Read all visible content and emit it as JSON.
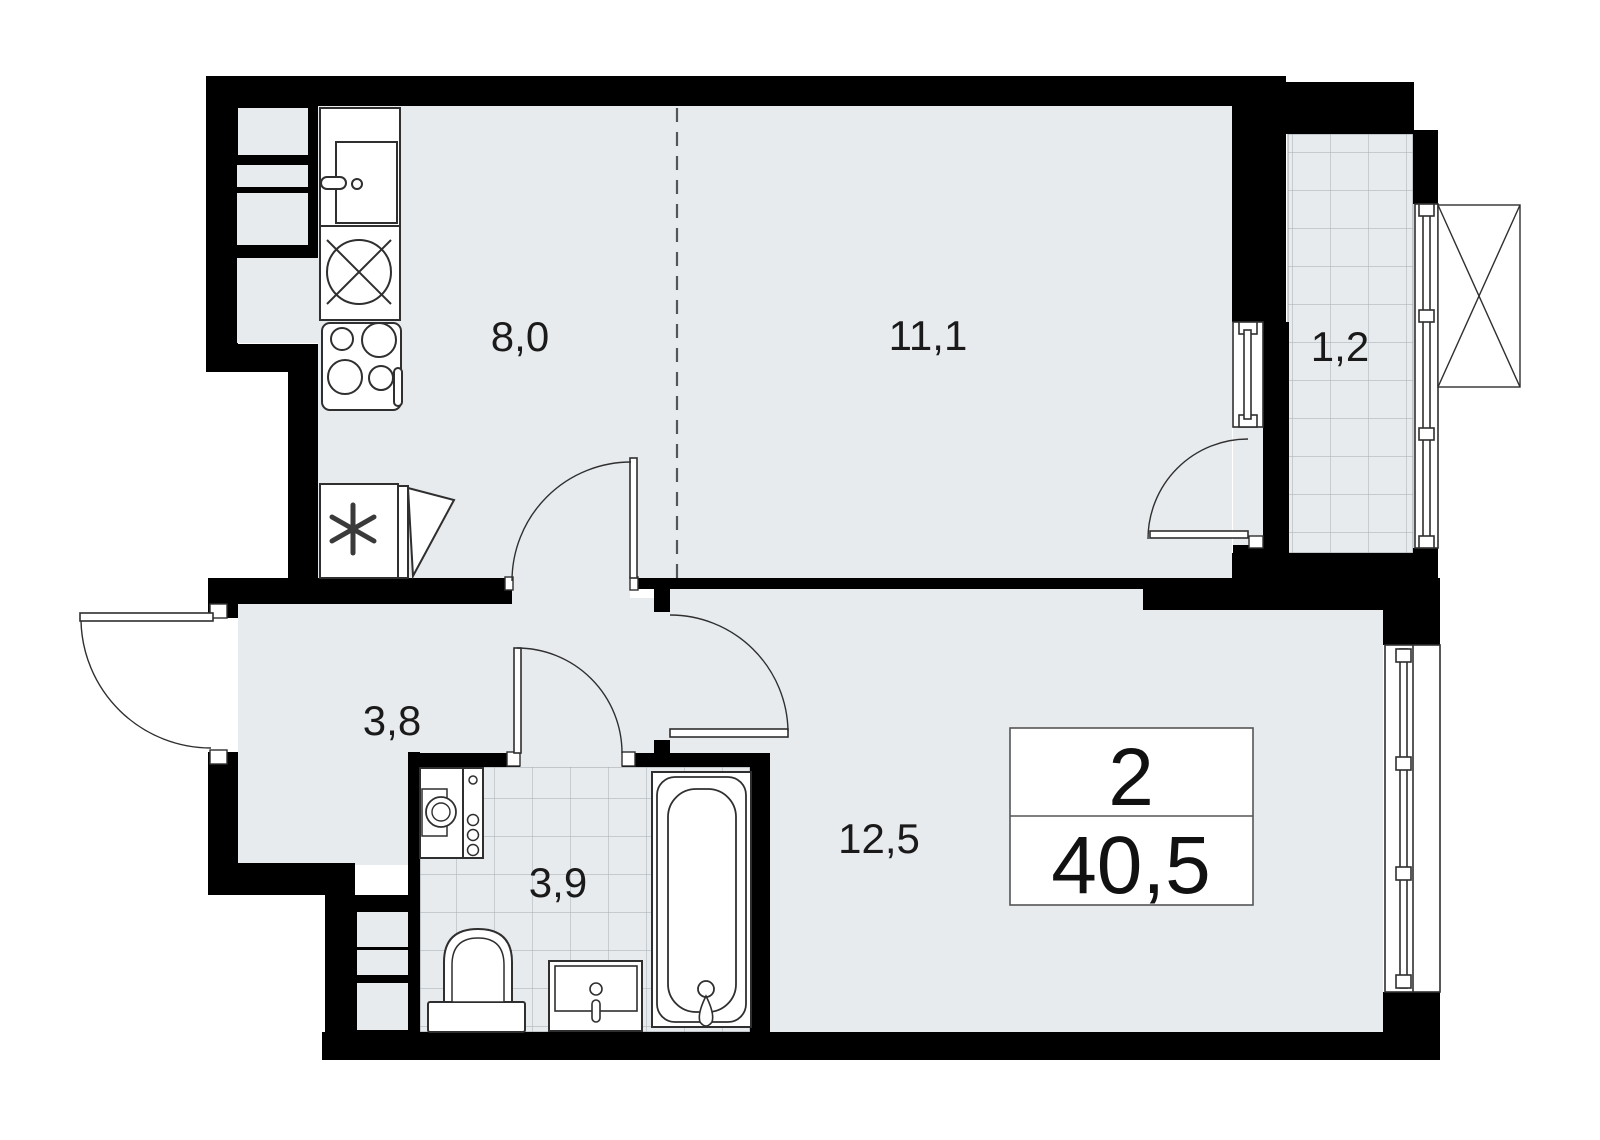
{
  "plan": {
    "type": "apartment-floor-plan",
    "rooms": [
      {
        "name": "kitchen",
        "area_label": "8,0"
      },
      {
        "name": "living-room",
        "area_label": "11,1"
      },
      {
        "name": "balcony",
        "area_label": "1,2"
      },
      {
        "name": "hallway",
        "area_label": "3,8"
      },
      {
        "name": "bathroom",
        "area_label": "3,9"
      },
      {
        "name": "bedroom-living",
        "area_label": "12,5"
      }
    ],
    "stamp": {
      "rooms_count": "2",
      "total_area": "40,5"
    },
    "colors": {
      "wall": "#000000",
      "floor": "#e8ebee",
      "tile_line": "#b0b6bb",
      "fixture_outline": "#2f2f2f",
      "background": "#ffffff"
    },
    "fixtures": [
      "kitchen-sink-icon",
      "round-appliance-icon",
      "stove-4-burner-icon",
      "refrigerator-icon",
      "washing-machine-icon",
      "toilet-icon",
      "wash-basin-icon",
      "bathtub-icon",
      "window-icon",
      "door-swing-icon",
      "ac-basket-x-icon"
    ]
  }
}
